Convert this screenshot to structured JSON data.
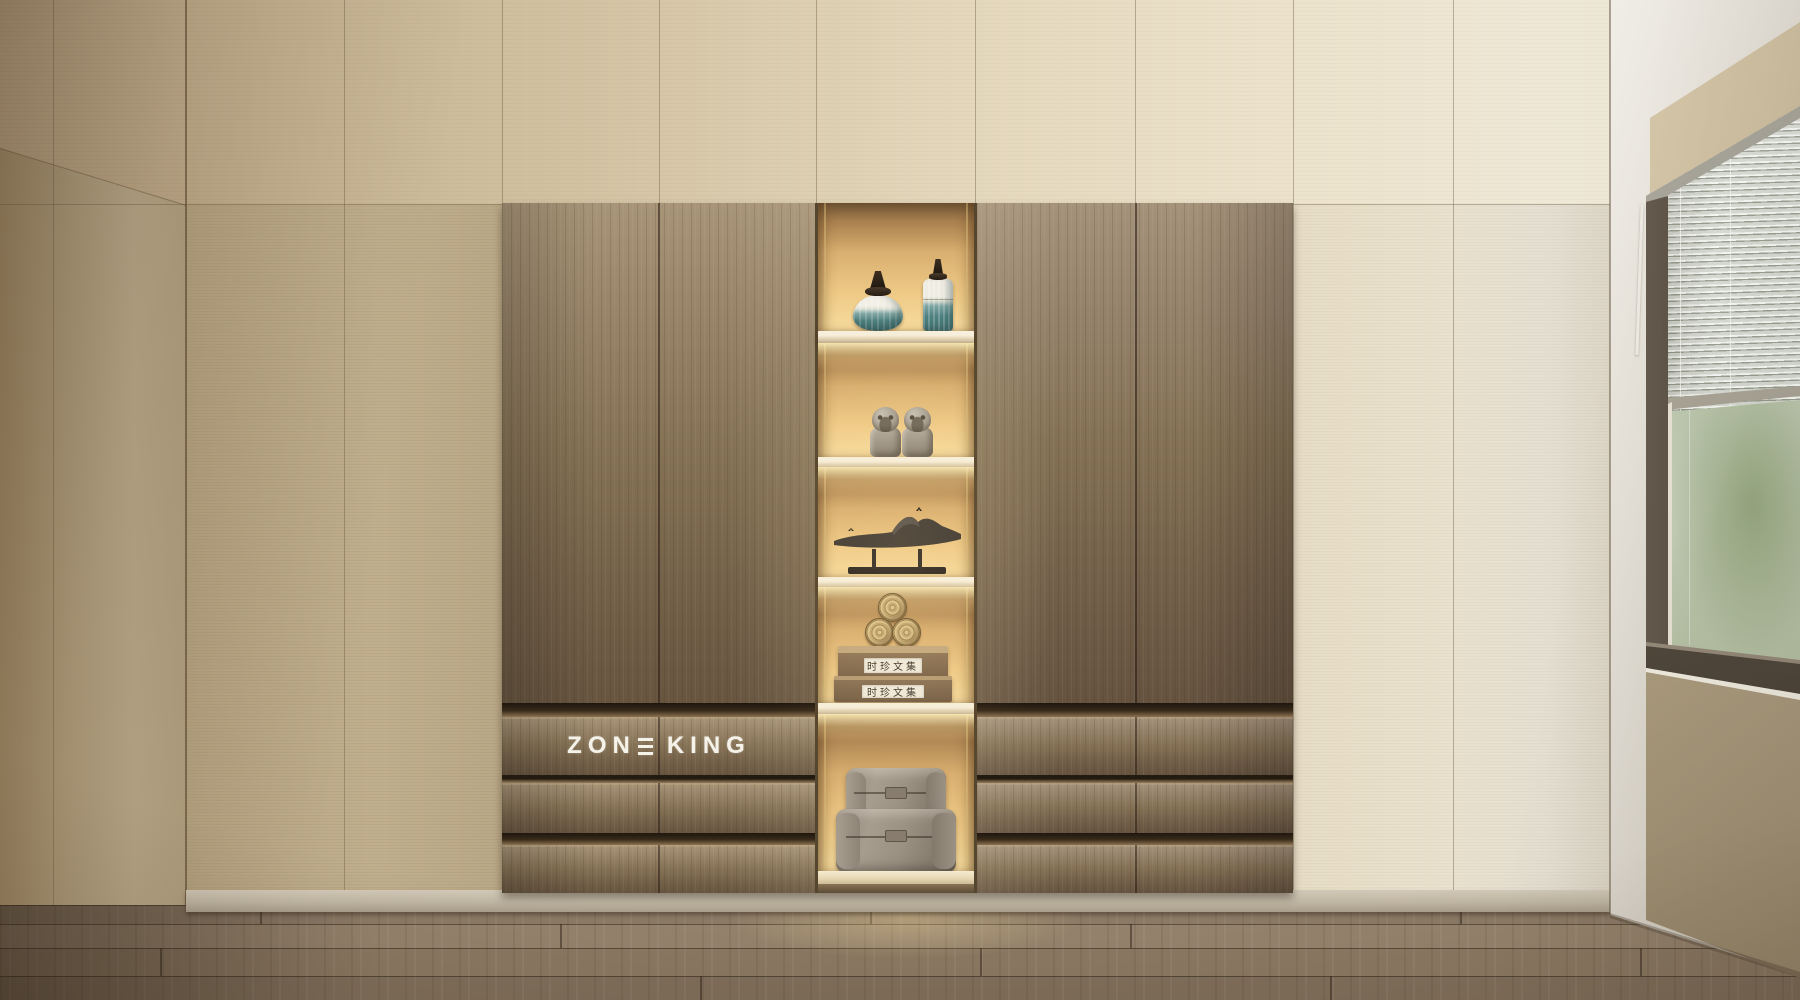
{
  "scene": {
    "description": "Minimalist interior render: built-in wardrobe with illuminated display niche, venetian-blind window, wood floor",
    "brand": {
      "name": "ZONE KING",
      "wordmark_left": "ZON",
      "wordmark_right": "KING"
    },
    "niche": {
      "book_spine_text": "时珍文集",
      "shelf_items": [
        "two teal ceramic lidded vases",
        "pair of stone guardian lion figurines",
        "dark abstract mountain sculpture on stand",
        "three bamboo scrolls on two stacked books",
        "two taupe storage chests"
      ]
    },
    "window": {
      "covering": "venetian-blinds",
      "view": "blurred green foliage"
    },
    "colors": {
      "wall_beige": "#cdbb9c",
      "wall_light": "#e9e2d2",
      "cabinet_wood_light": "#a79478",
      "cabinet_wood_dark": "#5f4e3a",
      "niche_glow": "#f0cd8b",
      "shelf_cream": "#f2e9d4",
      "vase_teal": "#4b7f7f",
      "floor_wood": "#8d7b66",
      "logo_white": "#f5f2ea"
    }
  }
}
